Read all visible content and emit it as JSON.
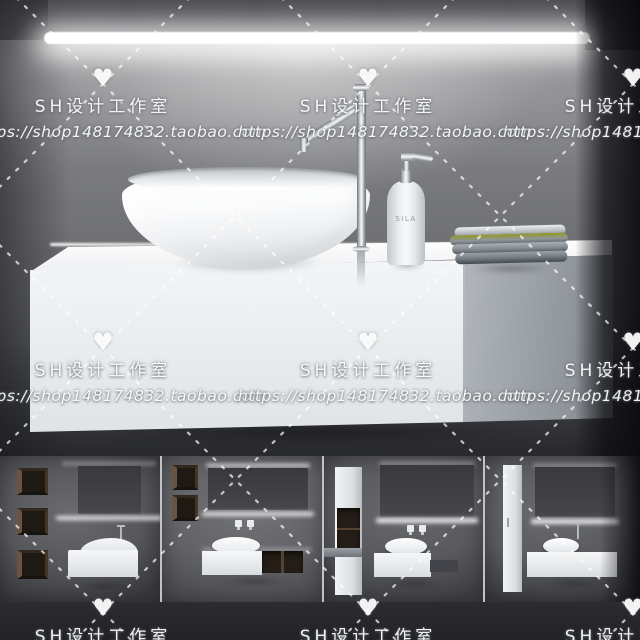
{
  "watermark": {
    "heart_icon": "♥",
    "studio_name": "SH设计工作室",
    "shop_url": "https://shop148174832.taobao.com"
  },
  "soap_bottle": {
    "label": "SILA"
  },
  "colors": {
    "wall_gray": "#77787b",
    "wall_dark_corner": "#1d1e22",
    "mirror_gray": "#3b3c40",
    "led_white": "#ffffff",
    "cabinet_white": "#eef0f2",
    "drawer_gray": "#959ba1",
    "towel_gray": "#8a9096",
    "wood_brown": "#5d4936",
    "chrome": "#dfe2e4",
    "watermark_white": "#ffffff",
    "footer_band": "#26272b"
  }
}
